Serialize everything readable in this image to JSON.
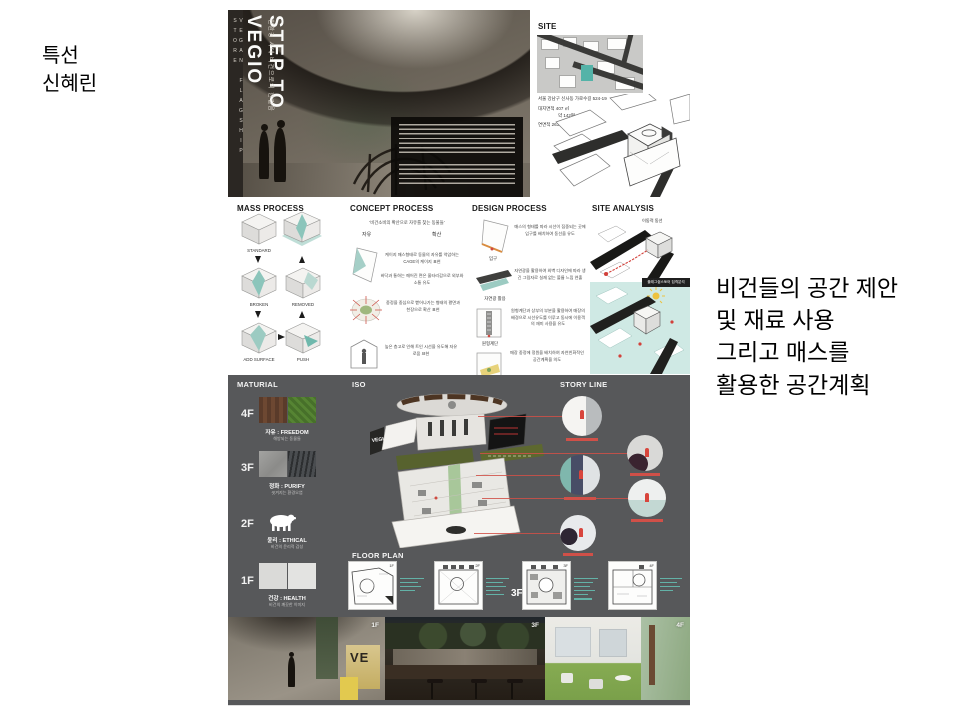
{
  "colors": {
    "teal": "#56b5a9",
    "red": "#d05048",
    "panel": "#57585a"
  },
  "annotations": {
    "award": "특선",
    "author": "신혜린",
    "caption_lines": [
      "비건들의 공간 제안",
      "및 재료 사용",
      "그리고 매스를",
      "활용한 공간계획"
    ]
  },
  "hero": {
    "side_label": "VEGAN FLAGSHIP STORE",
    "title": "STEP TO VEGIO",
    "subtitle": "친환경 시대 비건으로의 한걸음"
  },
  "site": {
    "header": "SITE",
    "address": "서울 강남구 신사동 가로수길 524-19",
    "area_lines": [
      "대지면적 407 ㎡",
      "약 142평",
      "연면적 2634 ㎡"
    ]
  },
  "mass": {
    "header": "MASS PROCESS",
    "labels": [
      "STANDARD",
      "BROKEN",
      "ADD SURFACE",
      "REMOVED",
      "PUSH"
    ]
  },
  "concept": {
    "header": "CONCEPT PROCESS",
    "quote": "'비건소비의 확산으로 자유를 찾는 동물들'",
    "terms": [
      "자유",
      "확산"
    ],
    "texts": [
      "케이지 매스형태로 동물의 자유를 억압하는 CAGE의 케이지 표현",
      "바닥과 통하는 깨어진 면은 울타리감으로 외부와 소통 유도",
      "중정을 중심으로 뻗어나가는 형태의 평면과 천장으로 확산 표현",
      "높은 층고로 인해 트인 시선을 유도해 자유로움 표현"
    ]
  },
  "design": {
    "header": "DESIGN PROCESS",
    "items": [
      {
        "label": "입구",
        "text": "매스의 형태를 따라 시선이 집중되는 곳에 입구를 배치하여 동선을 유도"
      },
      {
        "label": "자연광 활용",
        "text": "자연광을 활용하여 외벽 디자인에 따라 생긴 그림자로 실재 없는 볼륨 느낌 연출"
      },
      {
        "label": "원형계단",
        "text": "원형계단과 상부의 부분을 활용하여 매장의 배경으로 시선유도를 이루고 동시에 이용객의 재미 사용을 유도"
      },
      {
        "label": "중정정원",
        "text": "매장 중정에 정원을 배치하여 자연친화적인 공간계획을 의도"
      }
    ]
  },
  "analysis": {
    "header": "SITE ANALYSIS",
    "label_top": "이동적 동선",
    "label_bottom": "플래그쉽스토어 집객분석"
  },
  "material": {
    "header": "MATURIAL",
    "rows": [
      {
        "floor": "4F",
        "label": "자유 : FREEDOM",
        "sub": "해방되는 동물들"
      },
      {
        "floor": "3F",
        "label": "정화 : PURIFY",
        "sub": "씻겨지는 환경오염"
      },
      {
        "floor": "2F",
        "label": "윤리 : ETHICAL",
        "sub": "비건의 윤리적 감성"
      },
      {
        "floor": "1F",
        "label": "건강 : HEALTH",
        "sub": "비건의 깨끗한 이미지"
      }
    ]
  },
  "iso": {
    "header": "ISO",
    "band_label": "VEGIO"
  },
  "storyline": {
    "header": "STORY LINE"
  },
  "floorplan": {
    "header": "FLOOR PLAN",
    "floors": [
      "1F",
      "2F",
      "3F",
      "4F"
    ],
    "overlay_label": "3F"
  },
  "renders": {
    "labels": [
      "1F",
      "3F",
      "4F"
    ],
    "sign": "VE"
  }
}
